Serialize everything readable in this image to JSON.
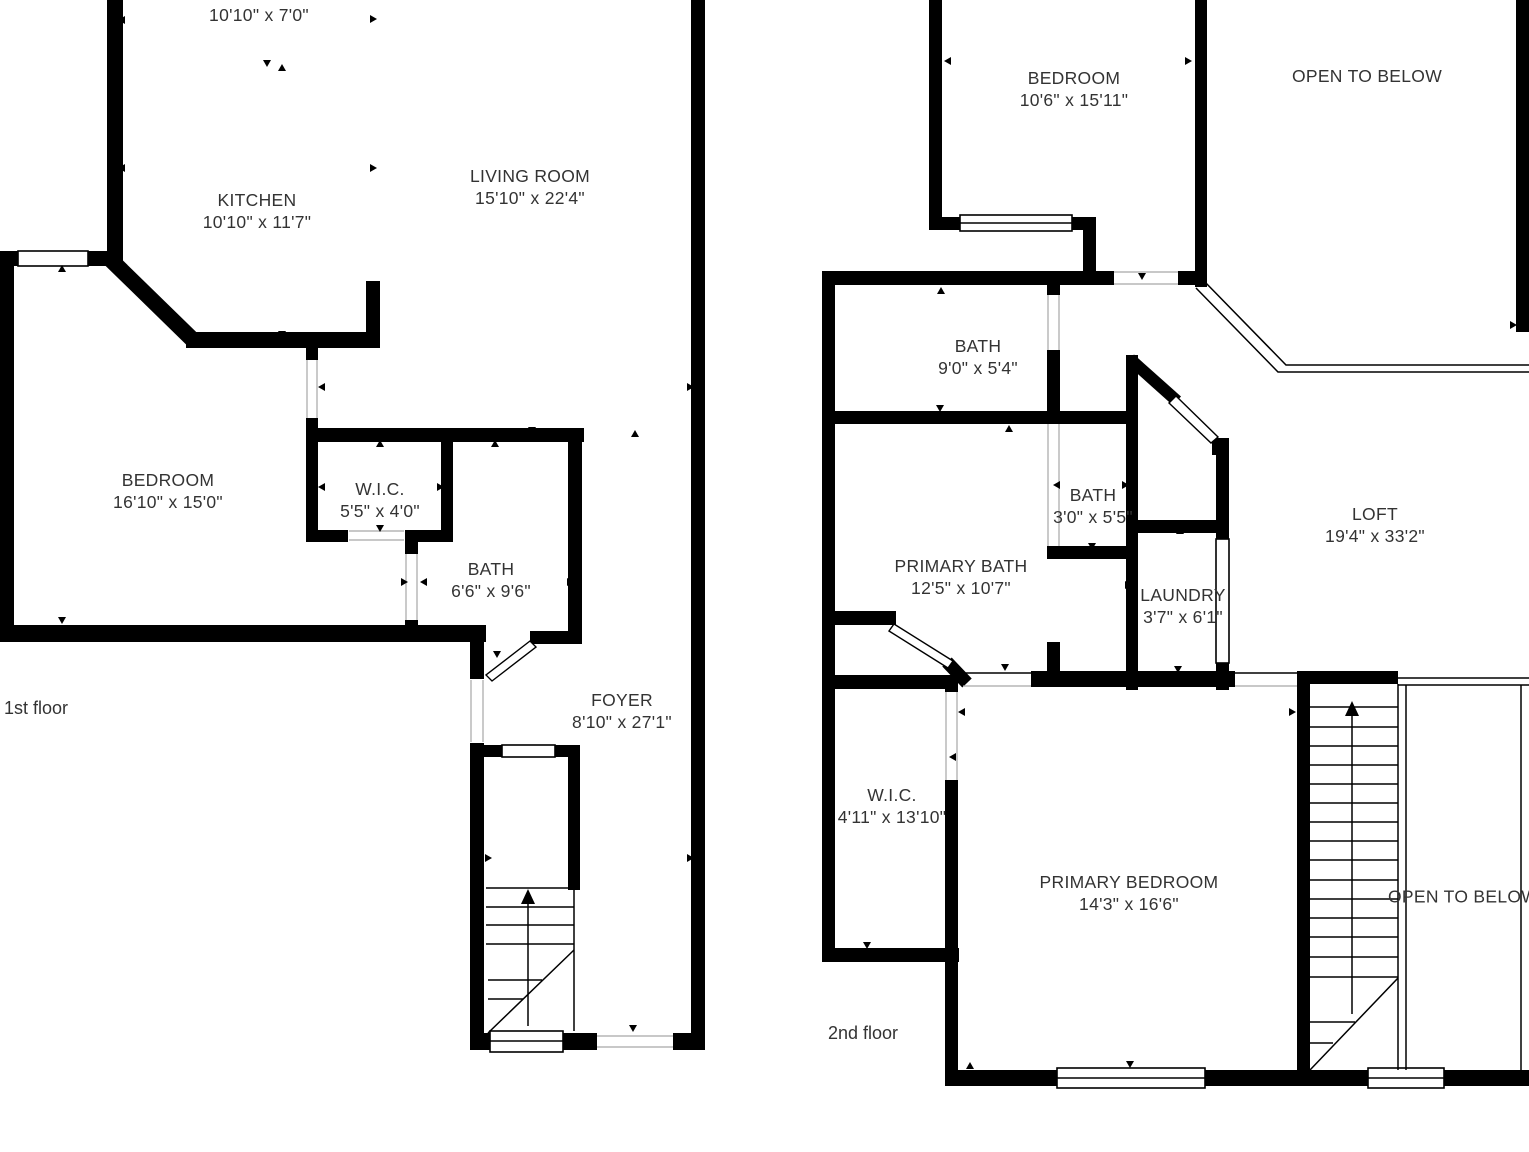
{
  "colors": {
    "background": "#ffffff",
    "walls": "#000000",
    "text": "#333333",
    "hairline": "#a6a6a6"
  },
  "floor1": {
    "caption": "1st floor",
    "rooms": {
      "upper": {
        "dims": "10'10\" x 7'0\""
      },
      "kitchen": {
        "name": "KITCHEN",
        "dims": "10'10\" x 11'7\""
      },
      "living_room": {
        "name": "LIVING ROOM",
        "dims": "15'10\" x 22'4\""
      },
      "bedroom": {
        "name": "BEDROOM",
        "dims": "16'10\" x 15'0\""
      },
      "wic": {
        "name": "W.I.C.",
        "dims": "5'5\" x 4'0\""
      },
      "bath": {
        "name": "BATH",
        "dims": "6'6\" x 9'6\""
      },
      "foyer": {
        "name": "FOYER",
        "dims": "8'10\" x 27'1\""
      }
    }
  },
  "floor2": {
    "caption": "2nd floor",
    "rooms": {
      "bedroom": {
        "name": "BEDROOM",
        "dims": "10'6\" x 15'11\""
      },
      "open_to_below_top": {
        "name": "OPEN TO BELOW"
      },
      "bath": {
        "name": "BATH",
        "dims": "9'0\" x 5'4\""
      },
      "bath_small": {
        "name": "BATH",
        "dims": "3'0\" x 5'5\""
      },
      "primary_bath": {
        "name": "PRIMARY BATH",
        "dims": "12'5\" x 10'7\""
      },
      "laundry": {
        "name": "LAUNDRY",
        "dims": "3'7\" x 6'1\""
      },
      "loft": {
        "name": "LOFT",
        "dims": "19'4\" x 33'2\""
      },
      "wic": {
        "name": "W.I.C.",
        "dims": "4'11\" x 13'10\""
      },
      "primary_bedroom": {
        "name": "PRIMARY BEDROOM",
        "dims": "14'3\" x 16'6\""
      },
      "open_to_below_bottom": {
        "name": "OPEN TO BELOW"
      }
    }
  }
}
